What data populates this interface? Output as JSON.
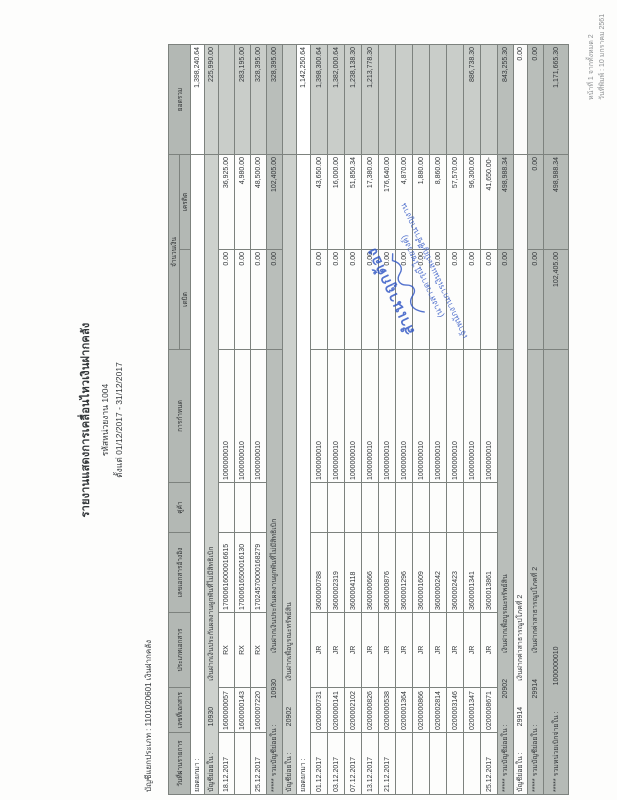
{
  "doc": {
    "title": "รายงานแสดงการเคลื่อนไหวเงินฝากคลัง",
    "org_line": "รหัสหน่วยงาน 1004",
    "period_line": "ตั้งแต่ 01/12/2017 - 31/12/2017",
    "gl_label": "บัญชีแยกประเภท : 1101020601  เงินฝากคลัง",
    "page_info_line1": "หน้าที่ 1 จากทั้งหมด 2",
    "page_info_line2": "วันที่พิมพ์ : 10 มกราคม 2561"
  },
  "table": {
    "headers": {
      "date": "วันที่ผ่านรายการ",
      "doc_no": "เลขที่เอกสาร",
      "doc_type": "ประเภทเอกสาร",
      "reference": "เลขเอกสารอ้างอิง",
      "partner": "คู่ค้า",
      "assignment": "การกำหนด",
      "amount_group": "จำนวนเงิน",
      "debit": "เดบิต",
      "credit": "เครดิต",
      "total": "ยอดรวม"
    },
    "column_widths": [
      62,
      45,
      75,
      80,
      50,
      133,
      100,
      95,
      110
    ]
  },
  "rows": [
    {
      "type": "carry",
      "label": "ยอดยกมา :",
      "balance": "1,398,240.64"
    },
    {
      "type": "section",
      "label": "บัญชีย่อยใน :",
      "id": "10930",
      "desc": "เงินฝากเงินประกันผลงานผูกพันที่ไม่มีสิทธิเบิก",
      "balance": "225,990.00"
    },
    {
      "type": "data1",
      "date": "18.12.2017",
      "doc_no": "1600000057",
      "doc_type": "RX",
      "reference": "17000616000016615",
      "partner": "",
      "assignment": "1000000010",
      "debit": "0.00",
      "credit": "36,925.00",
      "balance": ""
    },
    {
      "type": "data1",
      "date": "",
      "doc_no": "1600000143",
      "doc_type": "RX",
      "reference": "17000616500016130",
      "partner": "",
      "assignment": "1000000010",
      "debit": "0.00",
      "credit": "4,980.00",
      "balance": "283,195.00"
    },
    {
      "type": "data1",
      "date": "25.12.2017",
      "doc_no": "1600007220",
      "doc_type": "RX",
      "reference": "17024570000168279",
      "partner": "",
      "assignment": "1000000010",
      "debit": "0.00",
      "credit": "48,500.00",
      "balance": "328,395.00"
    },
    {
      "type": "total",
      "label": "***** รวมบัญชีย่อยใน :",
      "id": "10930",
      "desc": "เงินฝากเงินประกันผลงานผูกพันที่ไม่มีสิทธิเบิก",
      "debit": "0.00",
      "credit": "102,405.00",
      "balance": "328,395.00"
    },
    {
      "type": "section",
      "label": "บัญชีย่อยใน :",
      "id": "20902",
      "desc": "เงินฝากเพื่อบูรณะทรัพย์สิน",
      "balance": ""
    },
    {
      "type": "carry",
      "label": "ยอดยกมา :",
      "balance": "1,142,250.64"
    },
    {
      "type": "data2",
      "date": "01.12.2017",
      "doc_no": "0200000731",
      "doc_type": "JR",
      "reference": "3600000788",
      "partner": "",
      "assignment": "1000000010",
      "debit": "0.00",
      "credit": "43,650.00",
      "balance": "1,398,300.64"
    },
    {
      "type": "data2",
      "date": "03.12.2017",
      "doc_no": "0200000141",
      "doc_type": "JR",
      "reference": "3600002319",
      "partner": "",
      "assignment": "1000000010",
      "debit": "0.00",
      "credit": "16,000.00",
      "balance": "1,382,000.64"
    },
    {
      "type": "data2",
      "date": "07.12.2017",
      "doc_no": "0200002102",
      "doc_type": "JR",
      "reference": "3600004118",
      "partner": "",
      "assignment": "1000000010",
      "debit": "0.00",
      "credit": "51,850.34",
      "balance": "1,238,138.30"
    },
    {
      "type": "data2",
      "date": "13.12.2017",
      "doc_no": "0200000826",
      "doc_type": "JR",
      "reference": "3600000666",
      "partner": "",
      "assignment": "1000000010",
      "debit": "0.00",
      "credit": "17,380.00",
      "balance": "1,213,778.30"
    },
    {
      "type": "data2",
      "date": "21.12.2017",
      "doc_no": "0200000538",
      "doc_type": "JR",
      "reference": "3600000876",
      "partner": "",
      "assignment": "1000000010",
      "debit": "0.00",
      "credit": "176,640.00",
      "balance": ""
    },
    {
      "type": "data2",
      "date": "",
      "doc_no": "0200001364",
      "doc_type": "JR",
      "reference": "3600001296",
      "partner": "",
      "assignment": "1000000010",
      "debit": "0.00",
      "credit": "4,870.00",
      "balance": ""
    },
    {
      "type": "data2",
      "date": "",
      "doc_no": "0200000866",
      "doc_type": "JR",
      "reference": "3600001609",
      "partner": "",
      "assignment": "1000000010",
      "debit": "0.00",
      "credit": "1,880.00",
      "balance": ""
    },
    {
      "type": "data2",
      "date": "",
      "doc_no": "0200002814",
      "doc_type": "JR",
      "reference": "3600000242",
      "partner": "",
      "assignment": "1000000010",
      "debit": "0.00",
      "credit": "8,860.00",
      "balance": ""
    },
    {
      "type": "data2",
      "date": "",
      "doc_no": "0200003146",
      "doc_type": "JR",
      "reference": "3600002423",
      "partner": "",
      "assignment": "1000000010",
      "debit": "0.00",
      "credit": "57,570.00",
      "balance": ""
    },
    {
      "type": "data2",
      "date": "",
      "doc_no": "0200001347",
      "doc_type": "JR",
      "reference": "3600001341",
      "partner": "",
      "assignment": "1000000010",
      "debit": "0.00",
      "credit": "96,300.00",
      "balance": "886,738.30"
    },
    {
      "type": "data2",
      "date": "25.12.2017",
      "doc_no": "0200008671",
      "doc_type": "JR",
      "reference": "3600013861",
      "partner": "",
      "assignment": "1000000010",
      "debit": "0.00",
      "credit": "41,650.00-",
      "balance": ""
    },
    {
      "type": "total",
      "label": "***** รวมบัญชีย่อยใน :",
      "id": "20902",
      "desc": "เงินฝากเพื่อบูรณะทรัพย์สิน",
      "debit": "0.00",
      "credit": "498,988.34",
      "balance": "843,255.30"
    },
    {
      "type": "sectw",
      "label": "บัญชีย่อยใน :",
      "id": "29914",
      "desc": "เงินฝากค่าสาธารณูปโภคที่ 2",
      "balance": "0.00"
    },
    {
      "type": "total",
      "label": "***** รวมบัญชีย่อยใน :",
      "id": "29914",
      "desc": "เงินฝากค่าสาธารณูปโภคที่ 2",
      "debit": "0.00",
      "credit": "0.00",
      "balance": "0.00"
    },
    {
      "type": "grand",
      "label": "***** รวมหน่วยเบิกจ่ายใน :",
      "id": "1000000010",
      "desc": "",
      "debit": "102,405.00",
      "credit": "498,988.34",
      "balance": "1,171,665.30"
    }
  ],
  "stamp": {
    "certified": "สำเนาถูกต้อง",
    "name": "(นางสาวดารุณี ไชยวงค์)",
    "position": "เจ้าพนักงานการเงินและบัญชีชำนาญงาน",
    "ink_color": "#2f55c4"
  }
}
